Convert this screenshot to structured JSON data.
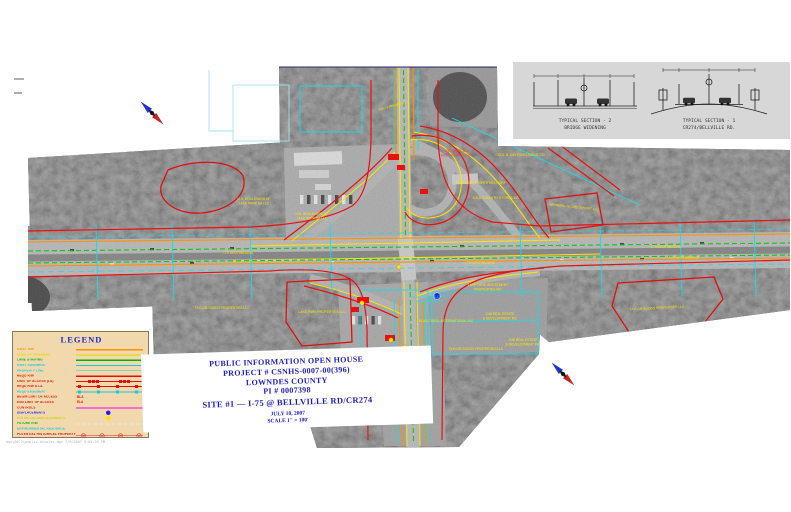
{
  "palette": {
    "photo_gray": "#8f8f8f",
    "forest_gray": "#565656",
    "exist_rw_orange": "#ff9000",
    "edge_of_pavement_yellow": "#ffe400",
    "lane_striping_green": "#00c800",
    "easement_cyan": "#18dce8",
    "reqd_rw_red": "#e81010",
    "controls_magenta": "#ff00ff",
    "displacement_blue": "#1818e8",
    "potential_displacement_yellow": "#ffe400",
    "title_blue": "#1d1db8",
    "legend_bg": "#f2d9ad"
  },
  "sheet": {
    "filepath": "dgn\\0072\\public-display.dgn   7/9/2007  3:04:24 PM"
  },
  "title_block": {
    "line1": "PUBLIC INFORMATION OPEN HOUSE",
    "line2": "PROJECT #  CSNHS-0007-00(396)",
    "line3": "LOWNDES  COUNTY",
    "line4": "PI #  0007398",
    "line5": "SITE #1 — I-75 @ BELLVILLE RD/CR274",
    "line6": "JULY 10, 2007",
    "line7": "SCALE 1\" = 100'"
  },
  "legend": {
    "title": "LEGEND",
    "rows": [
      {
        "label": "EXIST R/W"
      },
      {
        "label": "EDGE OF PAVEMENT"
      },
      {
        "label": "LANE STRIPING"
      },
      {
        "label": "EXIST EASEMENT"
      },
      {
        "label": "PROPERTY LINE"
      },
      {
        "label": "REQD R/W"
      },
      {
        "label": "LIMIT OF ACCESS (LA)"
      },
      {
        "label": "REQD R/W & LA"
      },
      {
        "label": "REQD EASEMENT"
      },
      {
        "label": "BEGIN LIMIT OF ACCESS",
        "sample": "BLA"
      },
      {
        "label": "END LIMIT OF ACCESS",
        "sample": "ELA"
      },
      {
        "label": "CONTROLS"
      },
      {
        "label": "DISPLACEMENTS"
      },
      {
        "label": "POTENTIAL DISPLACEMENTS"
      },
      {
        "label": "FUTURE R/W"
      },
      {
        "label": "ENVIRONMENTAL RESOURCE"
      },
      {
        "label": "POTENTIAL HISTORICAL PROPERTY"
      }
    ]
  },
  "typical_sections": {
    "section2": {
      "title": "TYPICAL SECTION - 2",
      "subtitle": "BRIDGE WIDENING"
    },
    "section1": {
      "title": "TYPICAL SECTION - 1",
      "subtitle": "CR274/BELLVILLE RD."
    }
  },
  "map": {
    "labels": [
      {
        "text": "KELLY PROPERTY"
      },
      {
        "text": "NEW RAMP 'B' &"
      },
      {
        "text": "BRIDGE WIDENING"
      },
      {
        "text": "CECIL B. DAY INVESTMENT CO"
      },
      {
        "text": "EASTGATE PROPERTIES CORP"
      },
      {
        "text": "A & D COUNTRY STORES INC"
      },
      {
        "text": "WINNERS-75 CHECKPOINT LLC"
      },
      {
        "text": "U.S. BOULEVARD OF"
      },
      {
        "text": "LAKE PARK GA LLC"
      },
      {
        "text": "U.S. BOULEVARD OF"
      },
      {
        "text": "LAKE PARK GA LLC"
      },
      {
        "text": "TAYLOR-SUGGS PROPERTIES LLC"
      },
      {
        "text": "LAKE PARK PROPERTIES LLC"
      },
      {
        "text": "LAKE PARK INVESTMENT"
      },
      {
        "text": "PROPERTIES INC"
      },
      {
        "text": "LAKE PARK INVESTMENT"
      },
      {
        "text": "PROPERTIES INC"
      },
      {
        "text": "BLUE CREEK INTERNATIONAL INC"
      },
      {
        "text": "JNB REAL ESTATE"
      },
      {
        "text": "& DEVELOPMENT INC"
      },
      {
        "text": "JNB REAL ESTATE"
      },
      {
        "text": "& DEVELOPMENT INC"
      },
      {
        "text": "TAYLOR-SUGGS PROPERTIES LLC"
      },
      {
        "text": "TAYLOR-SUGGS PROPERTIES LLC"
      },
      {
        "text": "I-75 SOUTHBOUND"
      },
      {
        "text": "I-75 NORTHBOUND"
      },
      {
        "text": "I-75 SOUTHBOUND"
      },
      {
        "text": "I-75 NORTHBOUND"
      },
      {
        "text": "BELLVILLE ROAD (CR 274)"
      }
    ]
  }
}
